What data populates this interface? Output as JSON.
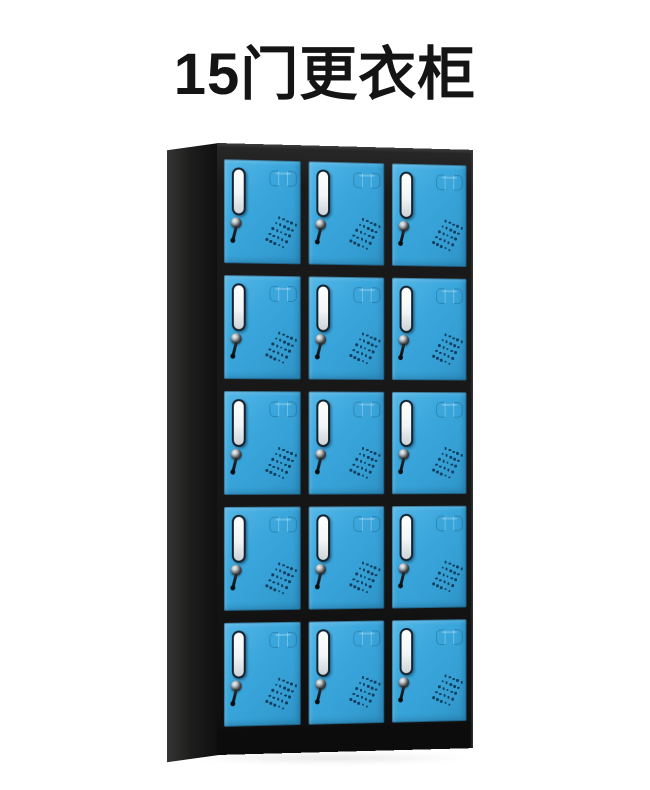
{
  "page": {
    "background_color": "#ffffff",
    "title": "15门更衣柜",
    "title_color": "#141414"
  },
  "cabinet": {
    "rows": 5,
    "columns": 3,
    "door_count": 15,
    "colors": {
      "door": "#3aa6dc",
      "door_highlight": "#55b7e7",
      "door_shadow": "#2d92c5",
      "frame": "#161616",
      "side_panel": "#1d1d1d",
      "label_card": "#ffffff",
      "vent_hole": "#0e3c5a"
    },
    "vent_pattern": {
      "lines": 5,
      "dots_per_line": 5
    }
  }
}
